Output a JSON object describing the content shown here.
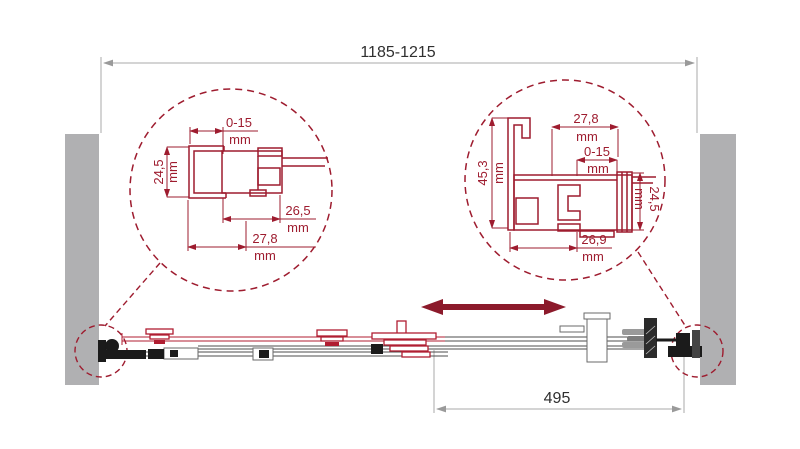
{
  "colors": {
    "detail_red": "#9e1c2f",
    "arrow_red": "#8c1a2b",
    "wall_gray": "#b0b0b2",
    "dim_line_gray": "#a8a8a8",
    "ink": "#2f2f2f",
    "hardware_dark": "#1b1b1b"
  },
  "dimensions": {
    "overall_width": {
      "value": "1185-1215"
    },
    "door_opening": {
      "value": "495"
    }
  },
  "left_detail": {
    "dim_adjust": {
      "value": "0-15",
      "unit": "mm"
    },
    "dim_depth": {
      "value": "24,5",
      "unit": "mm"
    },
    "dim_inner_width": {
      "value": "26,5",
      "unit": "mm"
    },
    "dim_profile_width": {
      "value": "27,8",
      "unit": "mm"
    }
  },
  "right_detail": {
    "dim_profile_width": {
      "value": "27,8",
      "unit": "mm"
    },
    "dim_adjust": {
      "value": "0-15",
      "unit": "mm"
    },
    "dim_height": {
      "value": "45,3",
      "unit": "mm"
    },
    "dim_depth": {
      "value": "24,5",
      "unit": "mm"
    },
    "dim_bottom_width": {
      "value": "26,9",
      "unit": "mm"
    }
  },
  "icons": {
    "slide_direction": "double-headed-arrow"
  }
}
